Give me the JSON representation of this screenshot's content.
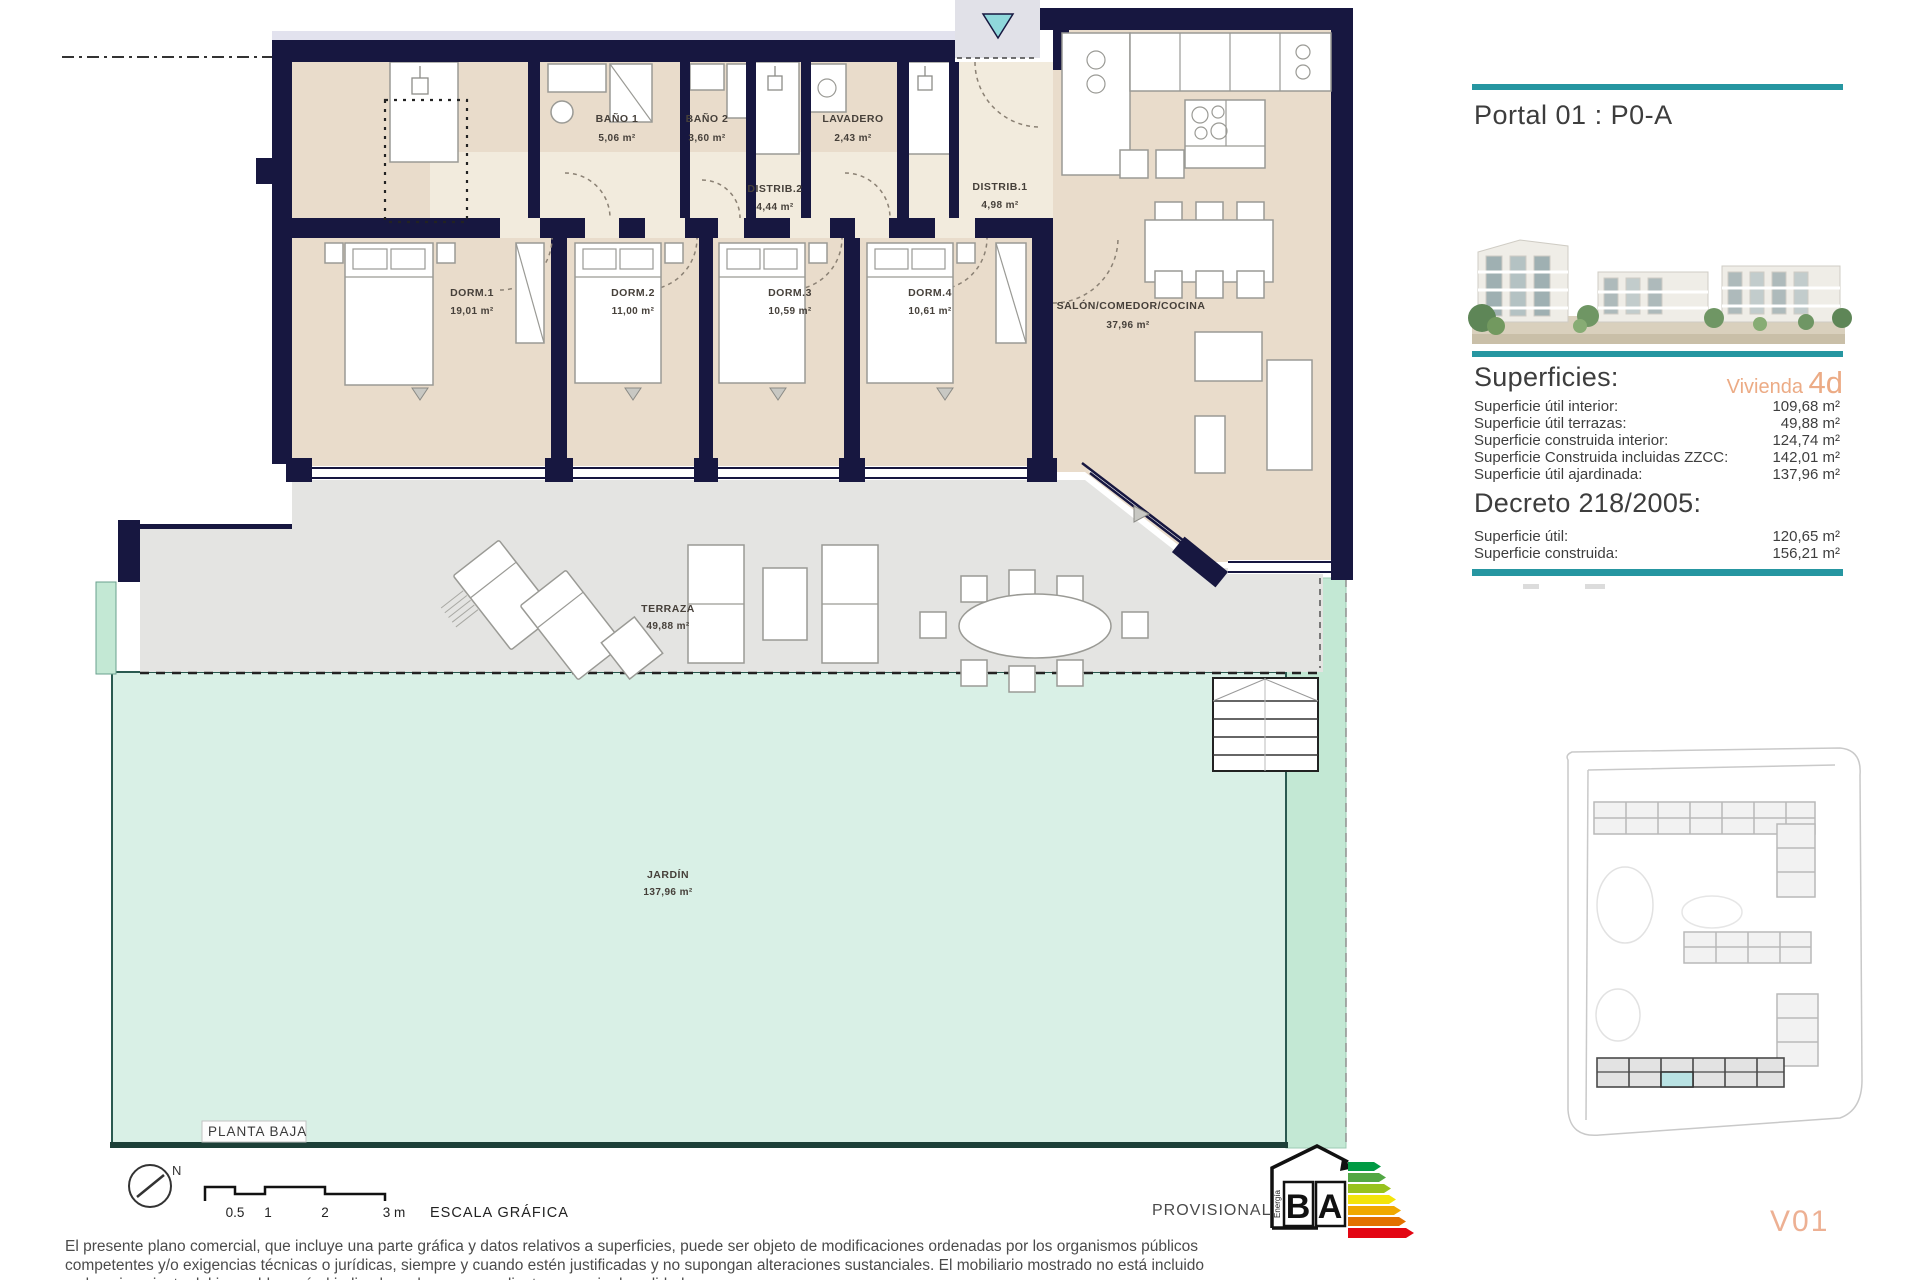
{
  "header": {
    "portal_title": "Portal 01 : P0-A"
  },
  "superficies": {
    "heading": "Superficies:",
    "vivienda_label": "Vivienda",
    "vivienda_code": "4d",
    "rows": [
      {
        "label": "Superficie útil interior:",
        "value": "109,68 m²"
      },
      {
        "label": "Superficie útil terrazas:",
        "value": "49,88 m²"
      },
      {
        "label": "Superficie construida interior:",
        "value": "124,74 m²"
      },
      {
        "label": "Superficie Construida incluidas ZZCC:",
        "value": "142,01 m²"
      },
      {
        "label": "Superficie útil ajardinada:",
        "value": "137,96 m²"
      }
    ]
  },
  "decreto": {
    "heading": "Decreto 218/2005:",
    "rows": [
      {
        "label": "Superficie útil:",
        "value": "120,65 m²"
      },
      {
        "label": "Superficie construida:",
        "value": "156,21 m²"
      }
    ]
  },
  "plan": {
    "floor_label": "PLANTA BAJA",
    "rooms": [
      {
        "name": "BAÑO 1",
        "area": "5,06 m²"
      },
      {
        "name": "BAÑO 2",
        "area": "3,60 m²"
      },
      {
        "name": "LAVADERO",
        "area": "2,43 m²"
      },
      {
        "name": "DISTRIB.2",
        "area": "4,44 m²"
      },
      {
        "name": "DISTRIB.1",
        "area": "4,98 m²"
      },
      {
        "name": "DORM.1",
        "area": "19,01 m²"
      },
      {
        "name": "DORM.2",
        "area": "11,00 m²"
      },
      {
        "name": "DORM.3",
        "area": "10,59 m²"
      },
      {
        "name": "DORM.4",
        "area": "10,61 m²"
      },
      {
        "name": "SALÓN/COMEDOR/COCINA",
        "area": "37,96 m²"
      },
      {
        "name": "TERRAZA",
        "area": "49,88 m²"
      },
      {
        "name": "JARDÍN",
        "area": "137,96 m²"
      }
    ]
  },
  "scale_bar": {
    "ticks": [
      "0.5",
      "1",
      "2",
      "3 m"
    ],
    "label": "ESCALA GRÁFICA",
    "north": "N"
  },
  "energy_label": {
    "letter_b": "B",
    "letter_a": "A",
    "energia": "Energía",
    "emisiones": "Emisiones"
  },
  "footer": {
    "provisional": "PROVISIONAL",
    "version": "V01",
    "disclaimer_lines": [
      "El presente plano comercial, que incluye una parte gráfica y datos relativos a superficies, puede ser objeto de modificaciones ordenadas por los organismos públicos",
      "competentes y/o exigencias técnicas o jurídicas, siempre y cuando estén justificadas y no supongan alteraciones sustanciales. El mobiliario mostrado no está incluido",
      "y el equipamiento del inmueble será el indicado en la correspondiente memoria de calidades."
    ]
  },
  "colors": {
    "accent_teal": "#2696a1",
    "accent_orange": "#ecab85",
    "wall_navy": "#171740",
    "garden_green": "#d9f0e6",
    "terrace_grey": "#e4e4e2",
    "room_beige": "#e9dccb",
    "site_highlight": "#b9e2e3"
  }
}
